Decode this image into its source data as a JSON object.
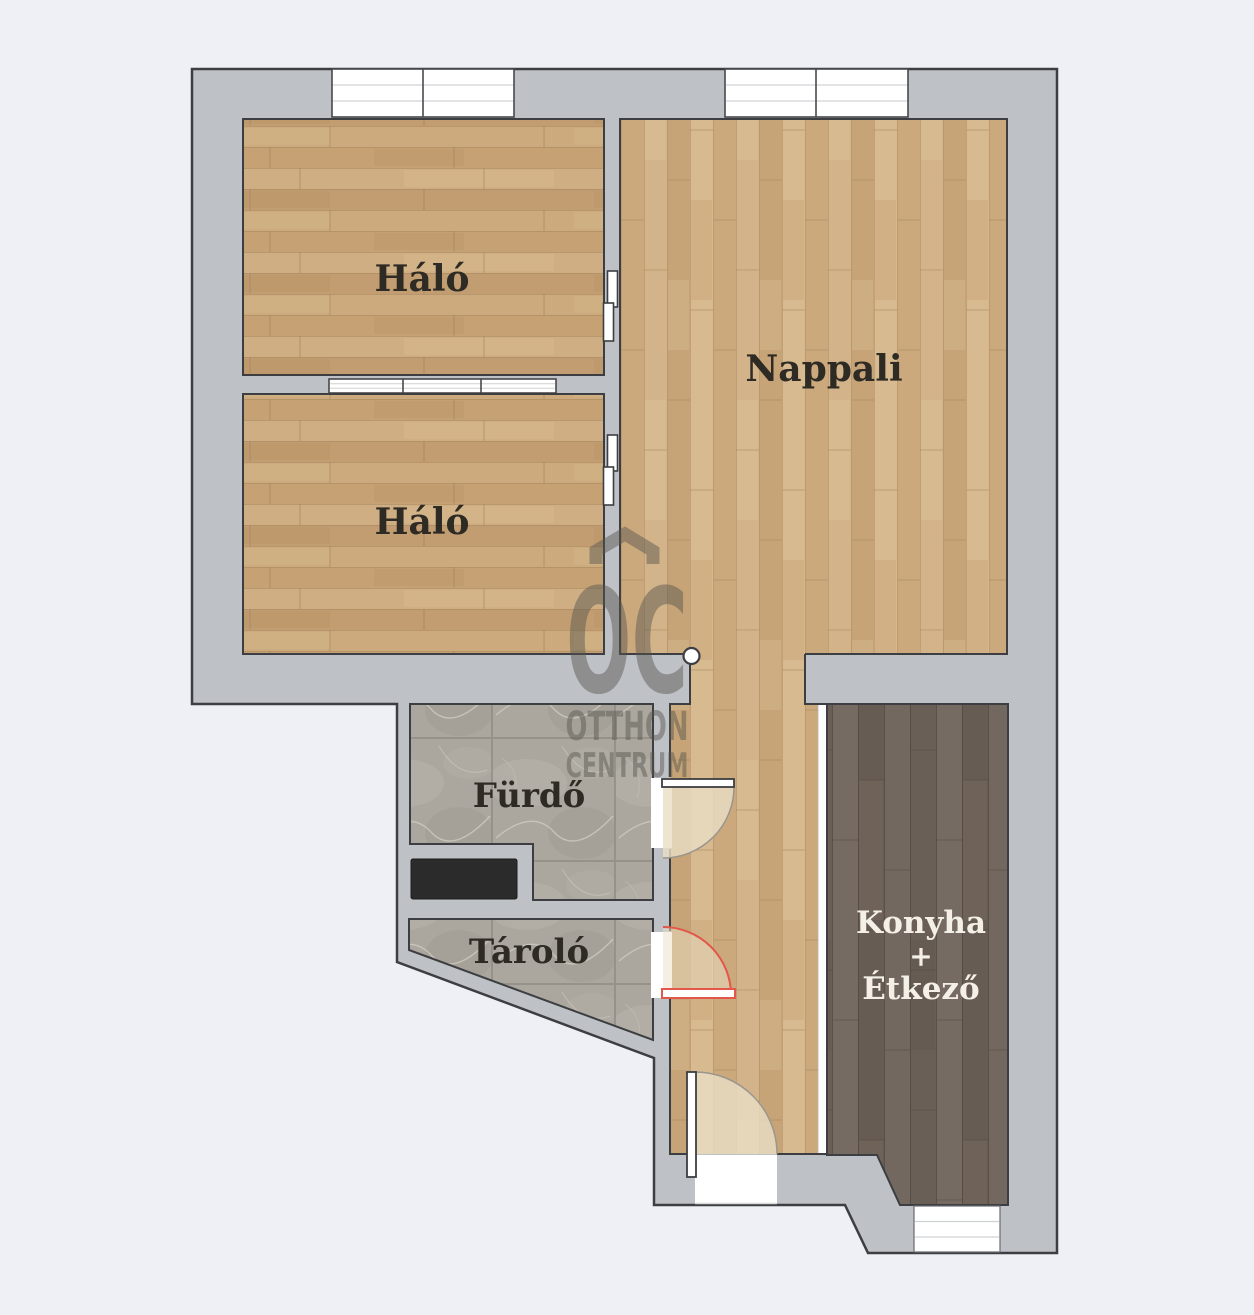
{
  "plan": {
    "rooms": {
      "bedroom_top": {
        "label": "Háló"
      },
      "bedroom_bottom": {
        "label": "Háló"
      },
      "living_room": {
        "label": "Nappali"
      },
      "bathroom": {
        "label": "Fürdő"
      },
      "storage": {
        "label": "Tároló"
      },
      "kitchen_dining": {
        "line1": "Konyha",
        "line2": "+",
        "line3": "Étkező"
      }
    },
    "watermark": {
      "monogram": "OC",
      "name_line1": "OTTHON",
      "name_line2": "CENTRUM"
    },
    "colors": {
      "background": "#eef0f5",
      "wall_fill": "#bec1c6",
      "outline": "#3c3e41",
      "storage_door_accent": "#e2574a",
      "label_dark": "#2e2a24",
      "label_light": "#f4f0e7"
    }
  }
}
